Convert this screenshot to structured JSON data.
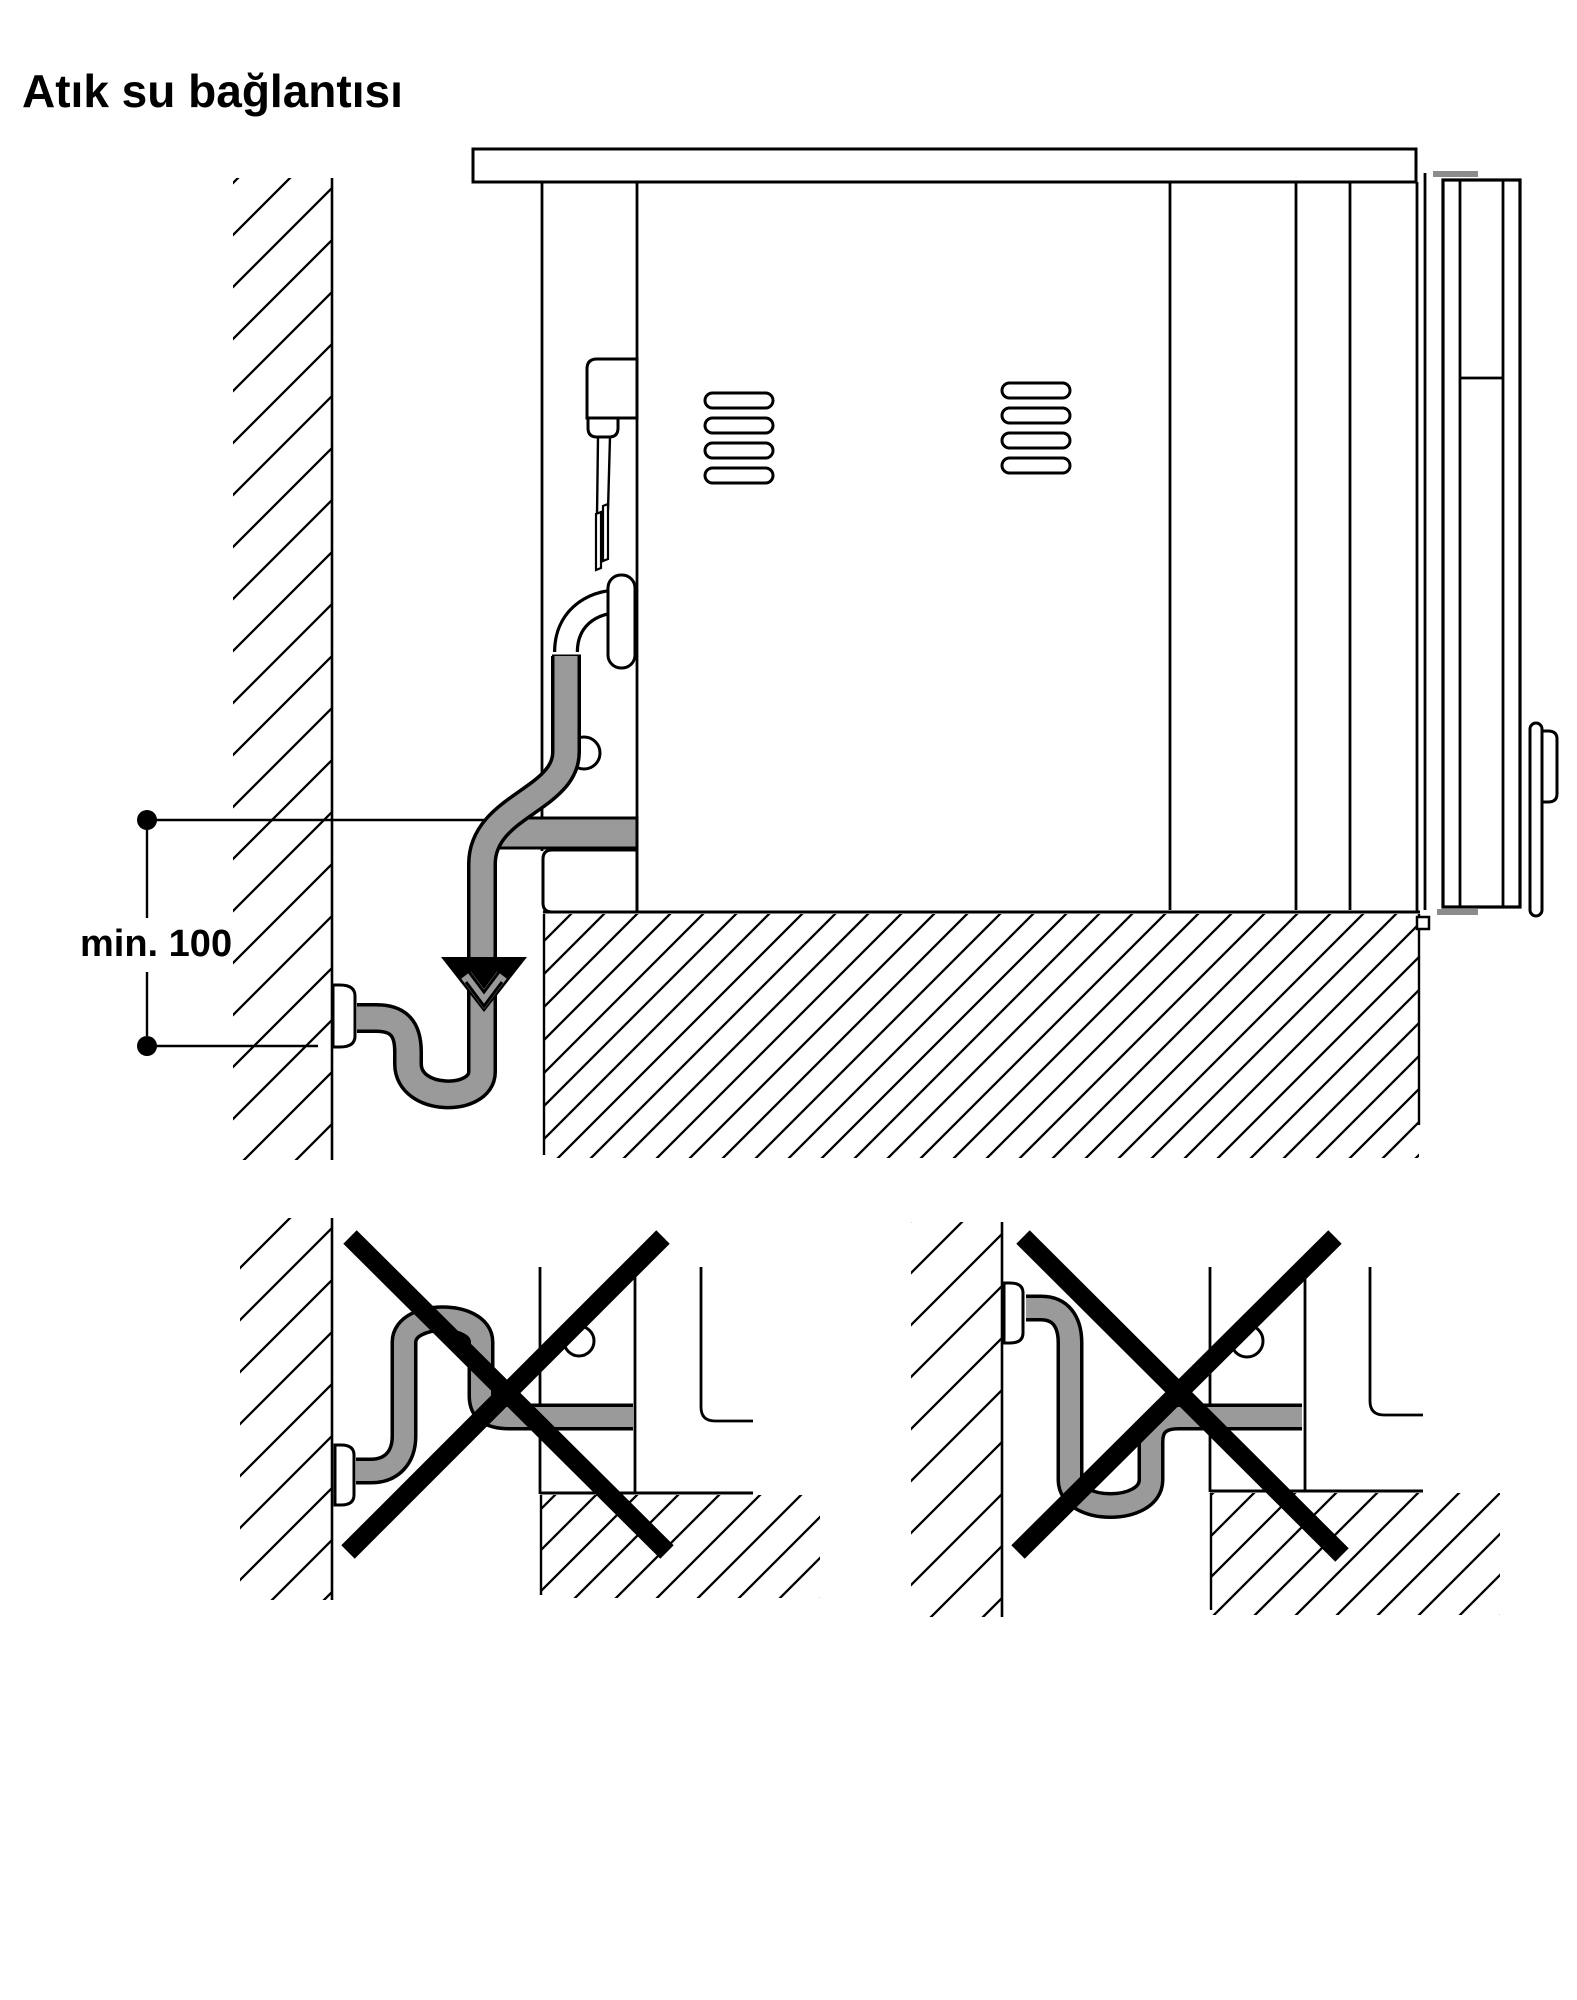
{
  "page": {
    "title": "Atık su bağlantısı",
    "language": "tr",
    "background": "#ffffff"
  },
  "figure": {
    "type": "appliance-drain-installation-diagram",
    "dimension_label": "min. 100",
    "icons": {
      "flow_arrow": "triangle-down",
      "prohibited_mark": "x-cross"
    },
    "views": {
      "main": "correct installation with siphon trap below wall drain",
      "wrong_example_1": "hose looped upward above drain - crossed out",
      "wrong_example_2": "hose sagging below drain connection - crossed out"
    }
  },
  "colors": {
    "line": "#000000",
    "hose": "#9a9a9a",
    "trim": "#8c8c8c",
    "background": "#ffffff"
  }
}
